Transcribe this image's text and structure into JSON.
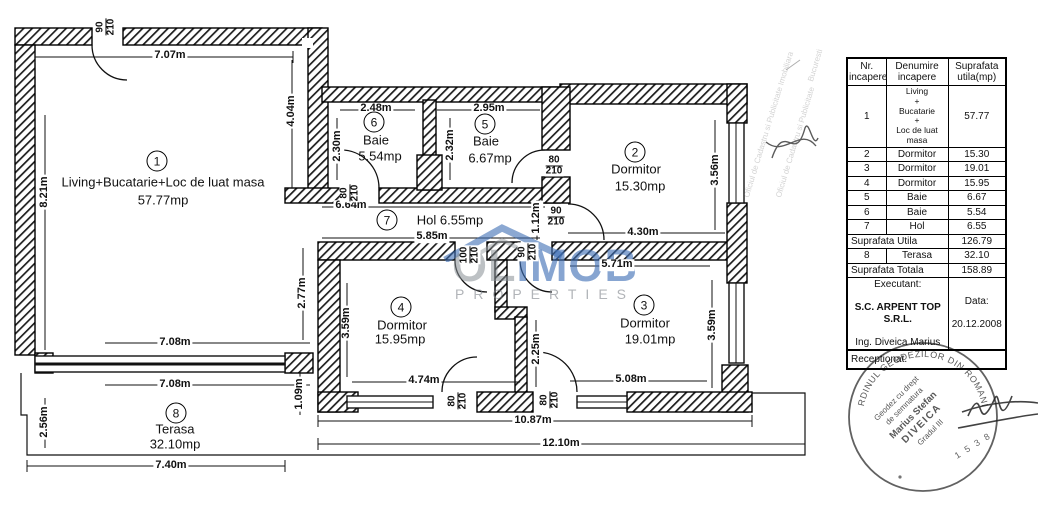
{
  "plan": {
    "rooms": [
      {
        "num": "1",
        "name": "Living+Bucatarie+Loc de luat masa",
        "area": "57.77mp",
        "cx": 157,
        "cy": 161,
        "nx": 163,
        "ny": 182,
        "ax": 163,
        "ay": 200
      },
      {
        "num": "2",
        "name": "Dormitor",
        "area": "15.30mp",
        "cx": 635,
        "cy": 152,
        "nx": 636,
        "ny": 169,
        "ax": 640,
        "ay": 186
      },
      {
        "num": "3",
        "name": "Dormitor",
        "area": "19.01mp",
        "cx": 644,
        "cy": 305,
        "nx": 645,
        "ny": 323,
        "ax": 650,
        "ay": 339
      },
      {
        "num": "4",
        "name": "Dormitor",
        "area": "15.95mp",
        "cx": 401,
        "cy": 307,
        "nx": 402,
        "ny": 325,
        "ax": 400,
        "ay": 339
      },
      {
        "num": "5",
        "name": "Baie",
        "area": "6.67mp",
        "cx": 485,
        "cy": 124,
        "nx": 486,
        "ny": 141,
        "ax": 490,
        "ay": 158
      },
      {
        "num": "6",
        "name": "Baie",
        "area": "5.54mp",
        "cx": 374,
        "cy": 122,
        "nx": 376,
        "ny": 140,
        "ax": 380,
        "ay": 156
      },
      {
        "num": "7",
        "name": "Hol",
        "area": "6.55mp",
        "inline": true,
        "cx": 387,
        "cy": 220,
        "nx": 450,
        "ny": 220
      },
      {
        "num": "8",
        "name": "Terasa",
        "area": "32.10mp",
        "cx": 176,
        "cy": 413,
        "nx": 175,
        "ny": 429,
        "ax": 175,
        "ay": 444
      }
    ],
    "dims": [
      {
        "t": "7.07m",
        "x": 170,
        "y": 56
      },
      {
        "t": "8.21m",
        "x": 45,
        "y": 192,
        "v": true
      },
      {
        "t": "4.04m",
        "x": 292,
        "y": 111,
        "v": true
      },
      {
        "t": "2.48m",
        "x": 376,
        "y": 109
      },
      {
        "t": "2.95m",
        "x": 489,
        "y": 109
      },
      {
        "t": "2.30m",
        "x": 338,
        "y": 146,
        "v": true
      },
      {
        "t": "2.32m",
        "x": 451,
        "y": 145,
        "v": true
      },
      {
        "t": "3.56m",
        "x": 716,
        "y": 170,
        "v": true
      },
      {
        "t": "6.64m",
        "x": 351,
        "y": 206
      },
      {
        "t": "5.85m",
        "x": 432,
        "y": 237
      },
      {
        "t": "1.12m",
        "x": 537,
        "y": 218,
        "v": true
      },
      {
        "t": "4.30m",
        "x": 643,
        "y": 233
      },
      {
        "t": "5.71m",
        "x": 617,
        "y": 265
      },
      {
        "t": "2.77m",
        "x": 303,
        "y": 293,
        "v": true
      },
      {
        "t": "3.59m",
        "x": 347,
        "y": 323,
        "v": true
      },
      {
        "t": "2.25m",
        "x": 537,
        "y": 349,
        "v": true
      },
      {
        "t": "3.59m",
        "x": 713,
        "y": 325,
        "v": true
      },
      {
        "t": "4.74m",
        "x": 424,
        "y": 381
      },
      {
        "t": "5.08m",
        "x": 631,
        "y": 380
      },
      {
        "t": "7.08m",
        "x": 175,
        "y": 343
      },
      {
        "t": "7.08m",
        "x": 175,
        "y": 385
      },
      {
        "t": "2.56m",
        "x": 45,
        "y": 422,
        "v": true
      },
      {
        "t": "1.09m",
        "x": 300,
        "y": 394,
        "v": true
      },
      {
        "t": "10.87m",
        "x": 533,
        "y": 421
      },
      {
        "t": "12.10m",
        "x": 561,
        "y": 444
      },
      {
        "t": "7.40m",
        "x": 171,
        "y": 466
      }
    ],
    "doors": [
      {
        "n": "90",
        "d": "210",
        "x": 106,
        "y": 27,
        "v": true
      },
      {
        "n": "80",
        "d": "210",
        "x": 350,
        "y": 193,
        "v": true
      },
      {
        "n": "80",
        "d": "210",
        "x": 554,
        "y": 166
      },
      {
        "n": "90",
        "d": "210",
        "x": 556,
        "y": 217
      },
      {
        "n": "100",
        "d": "210",
        "x": 470,
        "y": 255,
        "v": true
      },
      {
        "n": "90",
        "d": "210",
        "x": 528,
        "y": 252,
        "v": true
      },
      {
        "n": "80",
        "d": "210",
        "x": 458,
        "y": 401,
        "v": true
      },
      {
        "n": "80",
        "d": "210",
        "x": 550,
        "y": 400,
        "v": true
      }
    ]
  },
  "watermark": {
    "gray": "OL",
    "blue": "IMOB",
    "sub": "PROPERTIES"
  },
  "faint_stamp": {
    "lines": [
      "Oficiul de Cadastru si Publicitate Imobiliara",
      "Oficiul de Cadastru si Publicitate",
      "Bucuresti"
    ]
  },
  "table": {
    "headers": [
      "Nr.\nincapere",
      "Denumire\nincapere",
      "Suprafata\nutila(mp)"
    ],
    "row1": {
      "nr": "1",
      "name": "Living\n+\nBucatarie\n+\nLoc de luat masa",
      "area": "57.77"
    },
    "rows": [
      [
        "2",
        "Dormitor",
        "15.30"
      ],
      [
        "3",
        "Dormitor",
        "19.01"
      ],
      [
        "4",
        "Dormitor",
        "15.95"
      ],
      [
        "5",
        "Baie",
        "6.67"
      ],
      [
        "6",
        "Baie",
        "5.54"
      ],
      [
        "7",
        "Hol",
        "6.55"
      ]
    ],
    "subtotal_label": "Suprafata Utila",
    "subtotal_value": "126.79",
    "terasa_row": [
      "8",
      "Terasa",
      "32.10"
    ],
    "total_label": "Suprafata Totala",
    "total_value": "158.89",
    "executant": {
      "label": "Executant:",
      "company": "S.C. ARPENT TOP S.R.L.",
      "engineer": "Ing. Diveica Marius",
      "date_label": "Data:",
      "date": "20.12.2008"
    },
    "receptionat": "Receptionat."
  },
  "stamp": {
    "ring": "ORDINUL GEODEZILOR DIN ROMANIA",
    "lines": [
      "Geodez cu drept",
      "de semnatura",
      "Marius Stefan",
      "DIVEICA",
      "Gradul III"
    ],
    "number": "1 5 3 8"
  }
}
